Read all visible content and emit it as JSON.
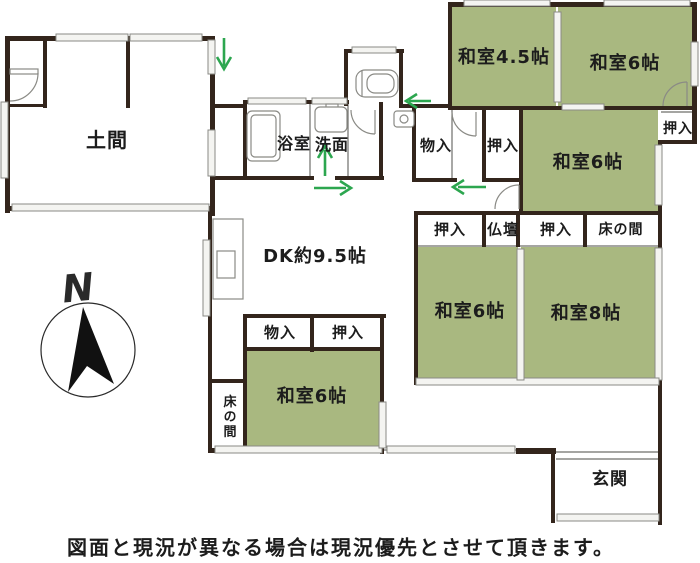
{
  "plan": {
    "type": "floor-plan",
    "rooms": {
      "doma": "土間",
      "bathroom": "浴室",
      "washroom": "洗面",
      "dining_kitchen": "DK約9.5帖",
      "washitsu_4_5": "和室4.5帖",
      "washitsu_6_ne": "和室6帖",
      "washitsu_6_e": "和室6帖",
      "washitsu_6_c": "和室6帖",
      "washitsu_8": "和室8帖",
      "washitsu_6_sw": "和室6帖",
      "genkan": "玄関"
    },
    "storage": {
      "monoire_n": "物入",
      "oshiire_n": "押入",
      "oshiire_ne": "押入",
      "oshiire_e1": "押入",
      "butsudan": "仏壇",
      "oshiire_e2": "押入",
      "tokonoma_e": "床の間",
      "monoire_sw": "物入",
      "oshiire_sw": "押入",
      "tokonoma_sw": "床の間"
    },
    "compass_label": "N",
    "caption": "図面と現況が異なる場合は現況優先とさせて頂きます。"
  },
  "colors": {
    "wall": "#33251c",
    "tatami": "#a9b880",
    "arrow": "#2ca64f",
    "line": "#8a8a85"
  }
}
